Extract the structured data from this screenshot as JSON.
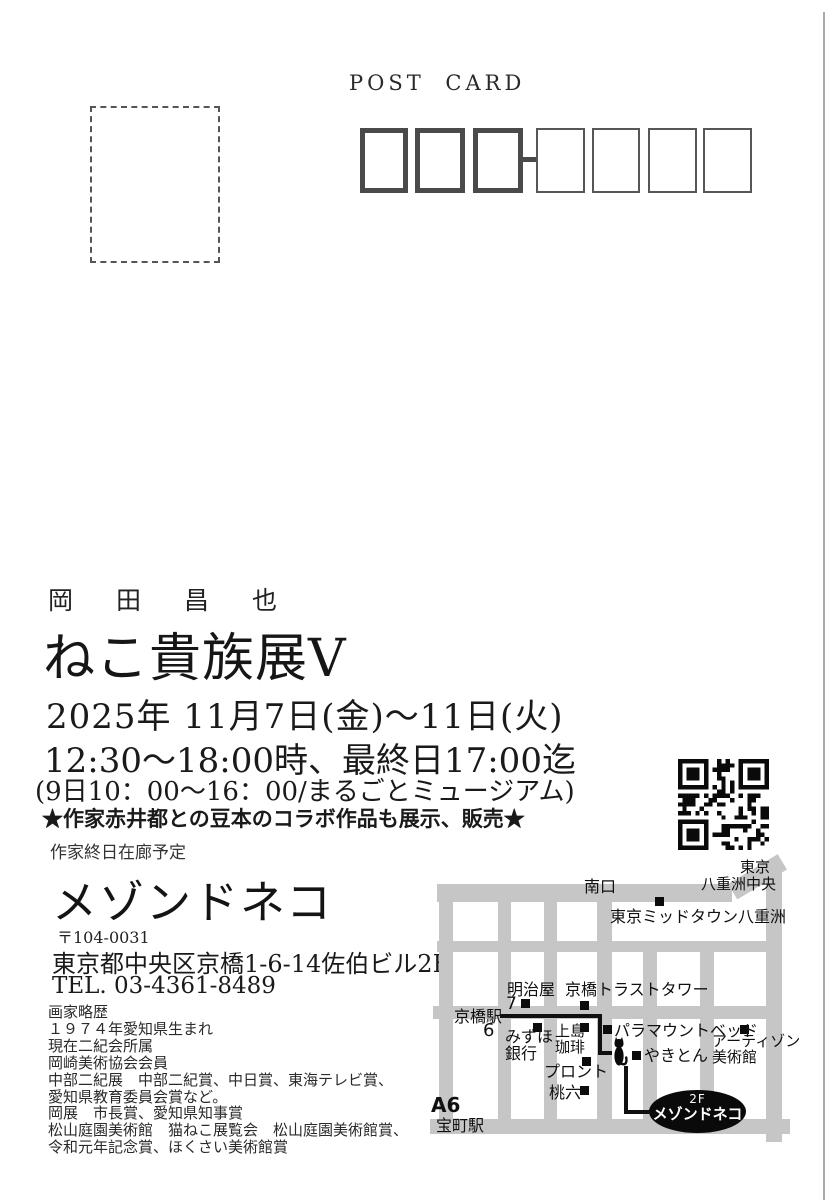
{
  "header": {
    "post_card_label": "POST CARD"
  },
  "exhibition": {
    "artist_name": "岡　田　昌　也",
    "title": "ねこ貴族展V",
    "date_line": "2025年 11月7日(金)～11日(火)",
    "time_line": "12:30～18:00時、最終日17:00迄",
    "note_line": "(9日10：00～16：00/まるごとミュージアム)",
    "collab_line": "★作家赤井都との豆本のコラボ作品も展示、販売★",
    "presence_line": "作家終日在廊予定"
  },
  "venue": {
    "name": "メゾンドネコ",
    "postal_code": "〒104-0031",
    "address": "東京都中央区京橋1-6-14佐伯ビル2F",
    "tel": "TEL. 03-4361-8489"
  },
  "bio": {
    "heading": "画家略歴",
    "lines": [
      "１９７４年愛知県生まれ",
      "現在二紀会所属",
      "岡崎美術協会会員",
      "中部二紀展　中部二紀賞、中日賞、東海テレビ賞、",
      "愛知県教育委員会賞など。",
      "岡展　市長賞、愛知県知事賞",
      "松山庭園美術館　猫ねこ展覧会　松山庭園美術館賞、",
      "令和元年記念賞、ほくさい美術館賞"
    ]
  },
  "map": {
    "south_exit": "南口",
    "tokyo": "東京",
    "yaesu_chuo": "八重洲中央",
    "midtown": "東京ミッドタウン八重洲",
    "meijiya": "明治屋",
    "exit7": "7",
    "trust_tower": "京橋トラストタワー",
    "kyobashi_station": "京橋駅",
    "exit6": "6",
    "mizuho_l1": "みずほ",
    "mizuho_l2": "銀行",
    "ueshima_l1": "上島",
    "ueshima_l2": "珈琲",
    "paramount": "パラマウントベッド",
    "artizon_l1": "アーティゾン",
    "artizon_l2": "美術館",
    "pronto": "プロント",
    "yakiton": "やきとん",
    "momoroku": "桃六",
    "a6": "A6",
    "takaracho_station": "宝町駅",
    "venue_floor": "2F",
    "venue_name": "メゾンドネコ"
  },
  "colors": {
    "road": "#c6c6c6",
    "route": "#101010",
    "ink": "#1e1e1e",
    "bubble_bg": "#0a0a0a",
    "bubble_text": "#ffffff"
  }
}
